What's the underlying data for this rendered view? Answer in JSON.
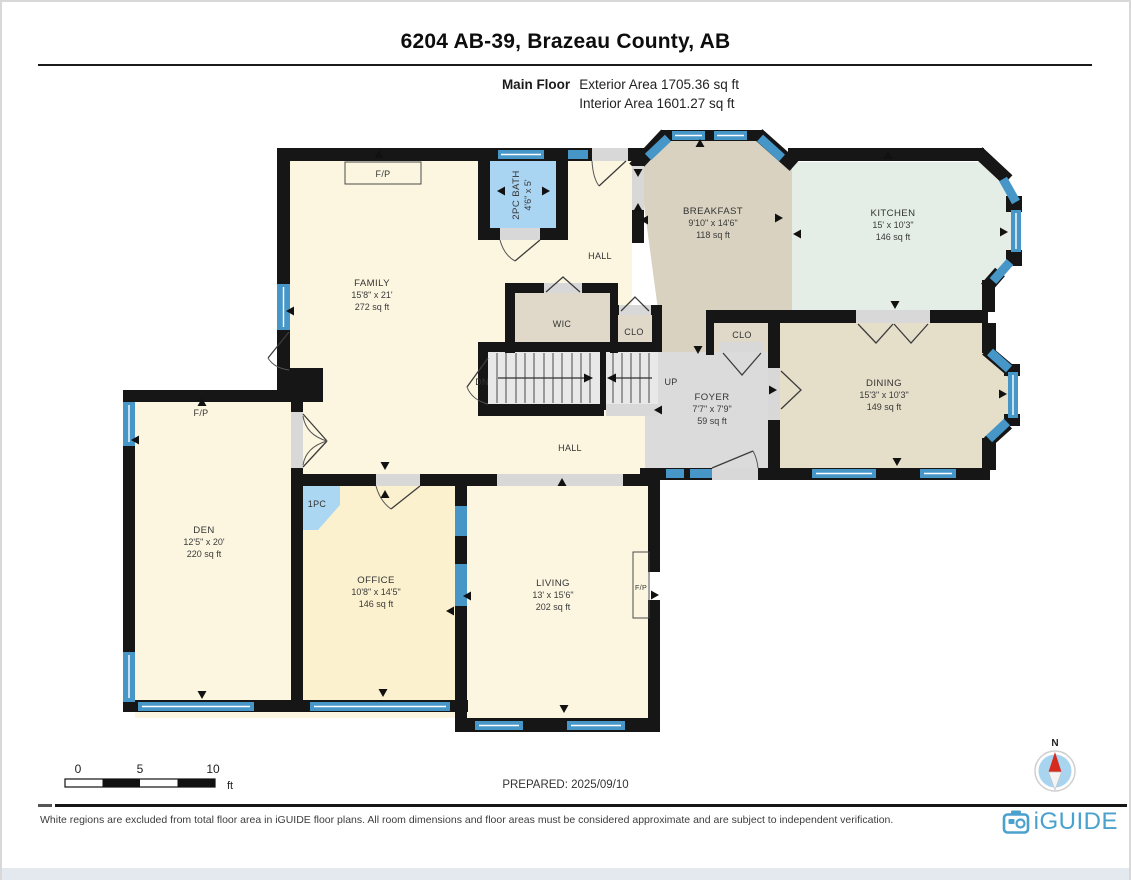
{
  "header": {
    "title": "6204 AB-39, Brazeau County, AB",
    "floor_label": "Main Floor",
    "exterior_area": "Exterior Area 1705.36 sq ft",
    "interior_area": "Interior Area 1601.27 sq ft"
  },
  "rooms": {
    "family": {
      "name": "FAMILY",
      "dims": "15'8\" x 21'",
      "area": "272 sq ft"
    },
    "breakfast": {
      "name": "BREAKFAST",
      "dims": "9'10\" x 14'6\"",
      "area": "118 sq ft"
    },
    "kitchen": {
      "name": "KITCHEN",
      "dims": "15' x 10'3\"",
      "area": "146 sq ft"
    },
    "dining": {
      "name": "DINING",
      "dims": "15'3\" x 10'3\"",
      "area": "149 sq ft"
    },
    "foyer": {
      "name": "FOYER",
      "dims": "7'7\" x 7'9\"",
      "area": "59 sq ft"
    },
    "den": {
      "name": "DEN",
      "dims": "12'5\" x 20'",
      "area": "220 sq ft"
    },
    "office": {
      "name": "OFFICE",
      "dims": "10'8\" x 14'5\"",
      "area": "146 sq ft"
    },
    "living": {
      "name": "LIVING",
      "dims": "13' x 15'6\"",
      "area": "202 sq ft"
    },
    "bath2pc": {
      "name": "2PC BATH",
      "dims": "4'6\" x 5'"
    }
  },
  "labels": {
    "hall": "HALL",
    "wic": "WIC",
    "clo": "CLO",
    "pc1": "1PC",
    "dn": "DN",
    "up": "UP",
    "fp": "F/P"
  },
  "scale": {
    "t0": "0",
    "t5": "5",
    "t10": "10",
    "unit": "ft"
  },
  "prepared": "PREPARED: 2025/09/10",
  "compass": {
    "north_label": "N"
  },
  "footer": {
    "disclaimer": "White regions are excluded from total floor area in iGUIDE floor plans. All room dimensions and floor areas must be considered approximate and are subject to independent verification.",
    "brand": "iGUIDE"
  },
  "colors": {
    "cream": "#FCF6E0",
    "office_yellow": "#FBF1CE",
    "breakfast_tan": "#D9D2C1",
    "dining_tan": "#E5DEC9",
    "kitchen_mint": "#E5EEE6",
    "foyer_gray": "#DBDBDB",
    "closet": "#E0D9C9",
    "bath_blue": "#A9D4F2",
    "window_blue": "#4796C8",
    "wall": "#161616",
    "brand_blue": "#4AA1CD",
    "compass_red": "#D42B1E"
  }
}
